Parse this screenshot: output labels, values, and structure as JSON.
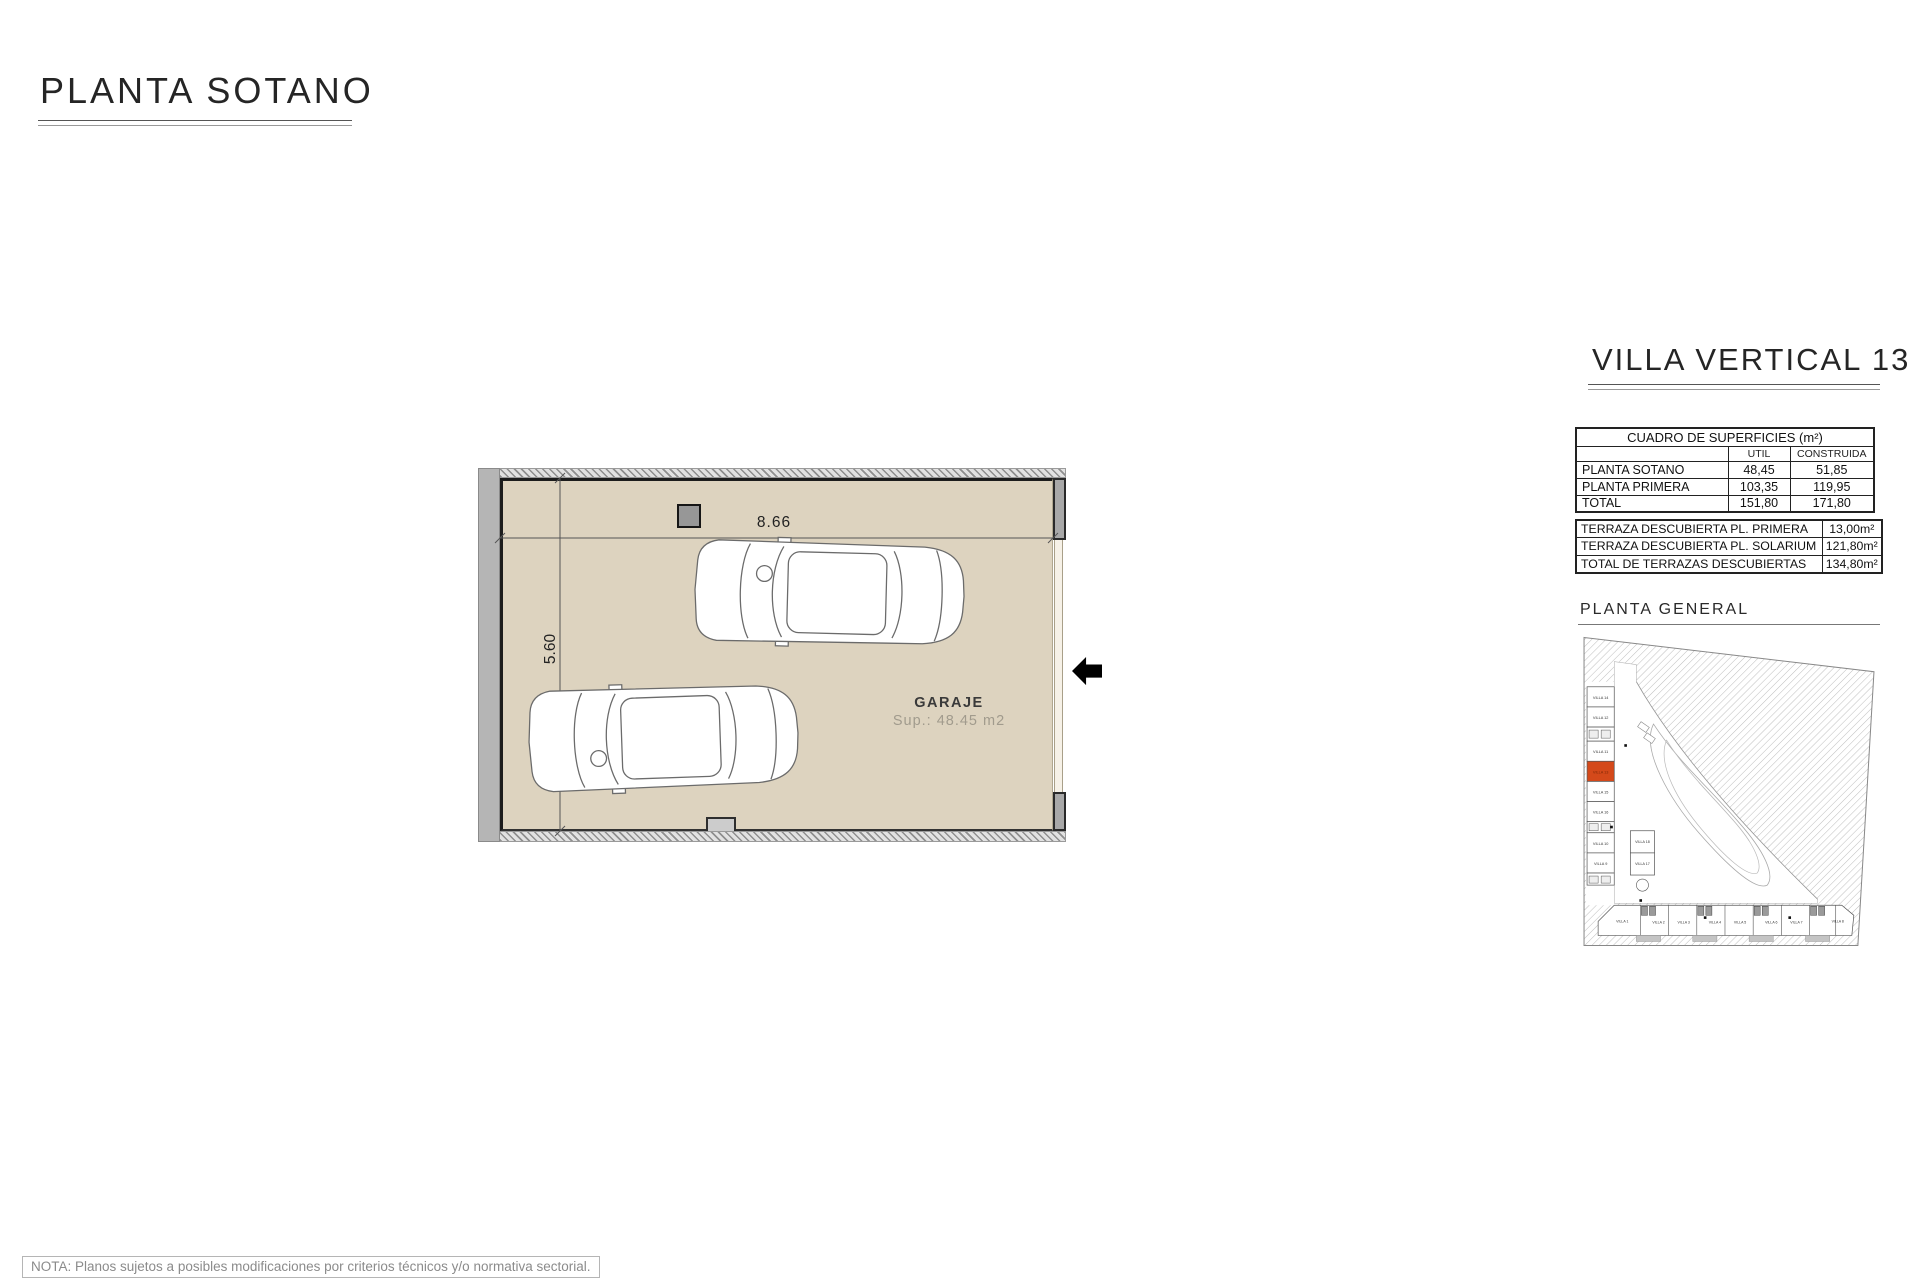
{
  "page": {
    "title": "PLANTA SOTANO",
    "note": "NOTA: Planos sujetos a posibles modificaciones por criterios técnicos y/o normativa sectorial."
  },
  "plan": {
    "room_label": "GARAJE",
    "room_area": "Sup.: 48.45 m2",
    "dim_width": "8.66",
    "dim_height": "5.60"
  },
  "panel": {
    "title": "VILLA VERTICAL 13",
    "surfaces_table": {
      "title": "CUADRO DE SUPERFICIES (m²)",
      "col_util": "UTIL",
      "col_construida": "CONSTRUIDA",
      "rows": [
        {
          "label": "PLANTA SOTANO",
          "util": "48,45",
          "construida": "51,85"
        },
        {
          "label": "PLANTA PRIMERA",
          "util": "103,35",
          "construida": "119,95"
        },
        {
          "label": "TOTAL",
          "util": "151,80",
          "construida": "171,80"
        }
      ]
    },
    "terraces_table": {
      "rows": [
        {
          "label": "TERRAZA DESCUBIERTA PL. PRIMERA",
          "value": "13,00m²"
        },
        {
          "label": "TERRAZA DESCUBIERTA PL. SOLARIUM",
          "value": "121,80m²"
        },
        {
          "label": "TOTAL DE TERRAZAS DESCUBIERTAS",
          "value": "134,80m²"
        }
      ]
    },
    "site_plan": {
      "label": "PLANTA GENERAL",
      "highlighted_villa": "VILLA 13",
      "left_column_villas": [
        "VILLA 14",
        "VILLA 12",
        "VILLA 11",
        "VILLA 13",
        "VILLA 15",
        "VILLA 16",
        "VILLA 10",
        "VILLA 9"
      ],
      "middle_villas": [
        "VILLA 18",
        "VILLA 17"
      ],
      "bottom_row_villas": [
        "VILLA 1",
        "VILLA 2",
        "VILLA 3",
        "VILLA 4",
        "VILLA 5",
        "VILLA 6",
        "VILLA 7",
        "VILLA 8"
      ]
    }
  },
  "colors": {
    "floor": "#ddd3bf",
    "wall": "#b3b3b3",
    "highlight": "#d4491a"
  }
}
